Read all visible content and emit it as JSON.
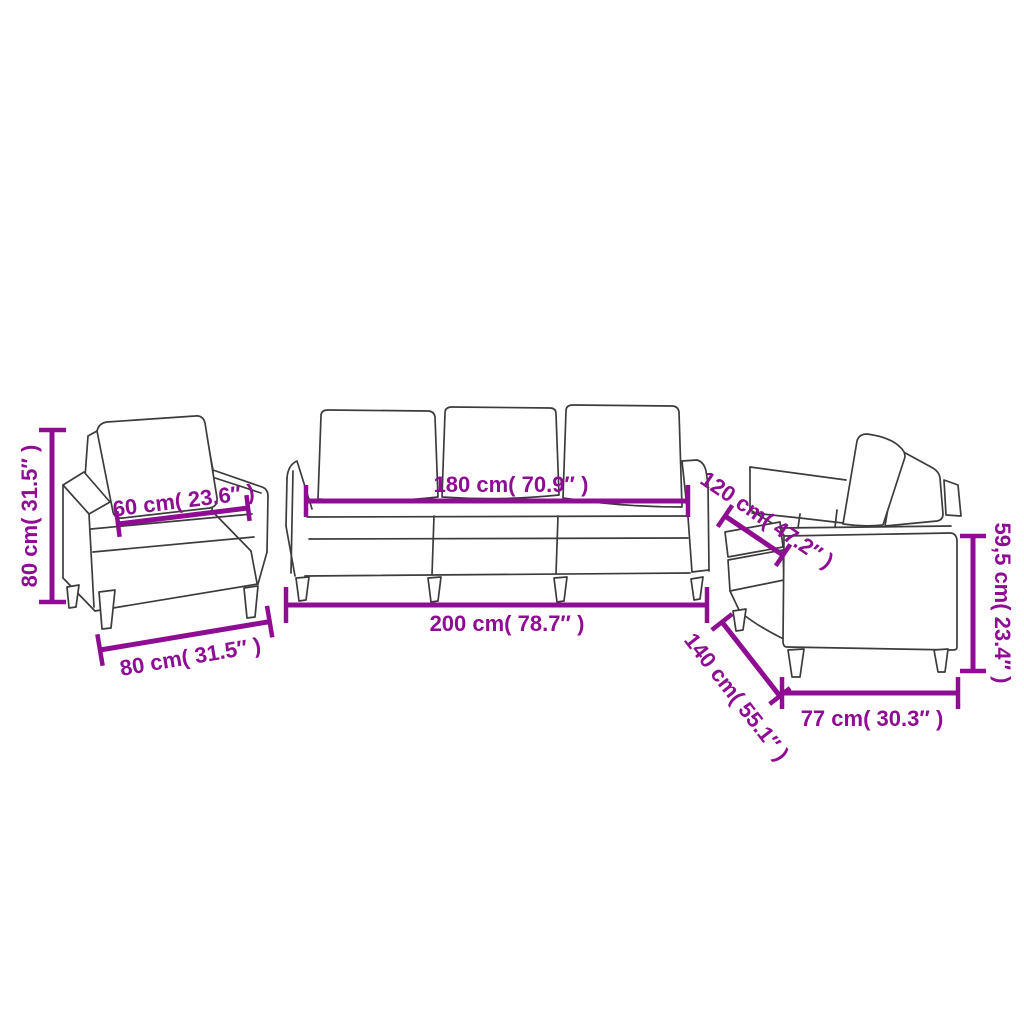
{
  "colors": {
    "dimension": "#8E0D92",
    "line_art": "#3C3C3C",
    "background": "#FFFFFF"
  },
  "pieces": {
    "armchair": {
      "height": "80 cm( 31.5″ )",
      "seat_width": "60 cm( 23.6″ )",
      "width": "80 cm( 31.5″ )"
    },
    "three_seater_sofa": {
      "seat_width": "180 cm( 70.9″ )",
      "width": "200 cm( 78.7″ )"
    },
    "two_seater_sofa": {
      "depth_upper": "120 cm( 47.2″ )",
      "depth_lower": "140 cm( 55.1″ )",
      "height": "59,5 cm( 23.4″ )",
      "width": "77 cm( 30.3″ )"
    }
  }
}
